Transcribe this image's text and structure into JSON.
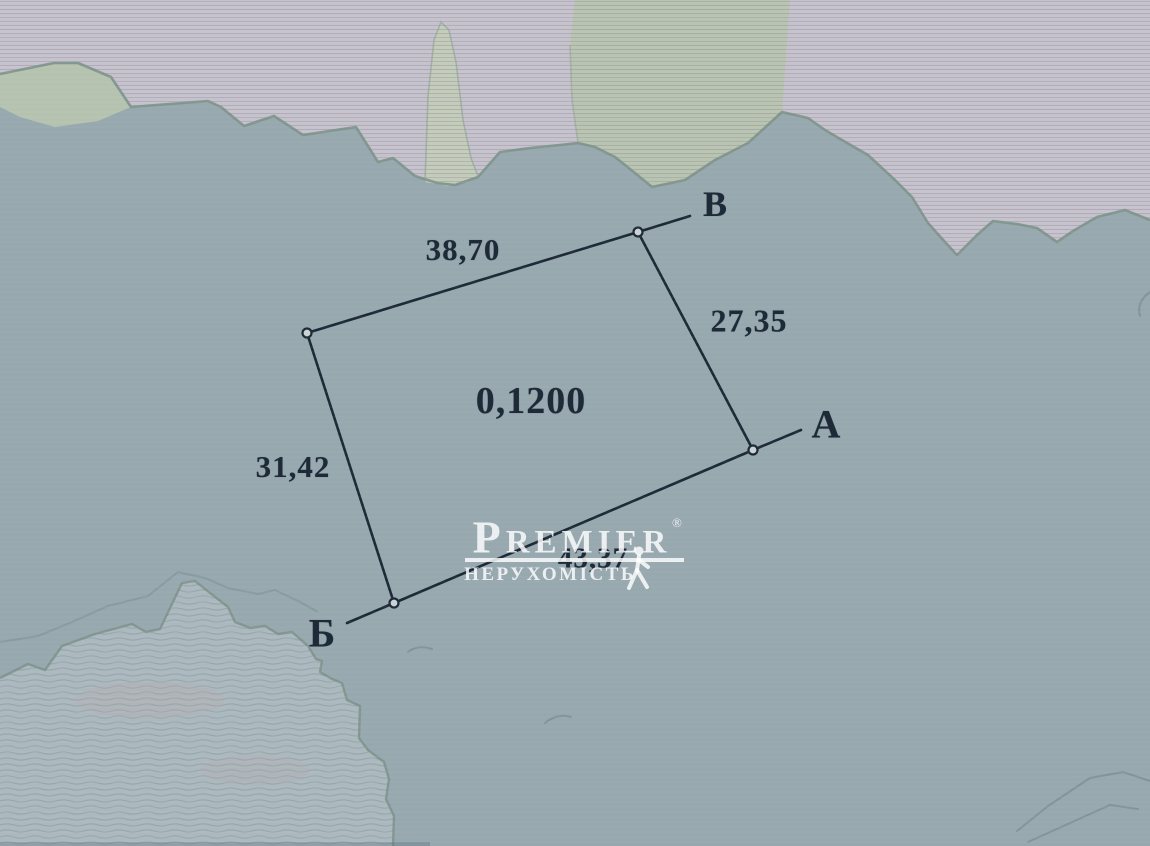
{
  "parcel": {
    "area": "0,1200",
    "vertices": {
      "top_right": "В",
      "right": "А",
      "bottom_left": "Б"
    },
    "sides": {
      "top": "38,70",
      "right": "27,35",
      "left": "31,42",
      "bottom": "43,37"
    }
  },
  "watermark": {
    "brand": "PREMIER",
    "registered_mark": "®",
    "subtitle": "НЕРУХОМІСТЬ"
  },
  "colors": {
    "paper_blue": "#97a8af",
    "upper_region_pink": "#c6c3cc",
    "green_patch": "#b9c5b0",
    "lowland_region": "#abb8bd",
    "terrain_boundary": "#7d928b",
    "survey_ink": "#1e2a38",
    "watermark_white": "#ffffff"
  }
}
